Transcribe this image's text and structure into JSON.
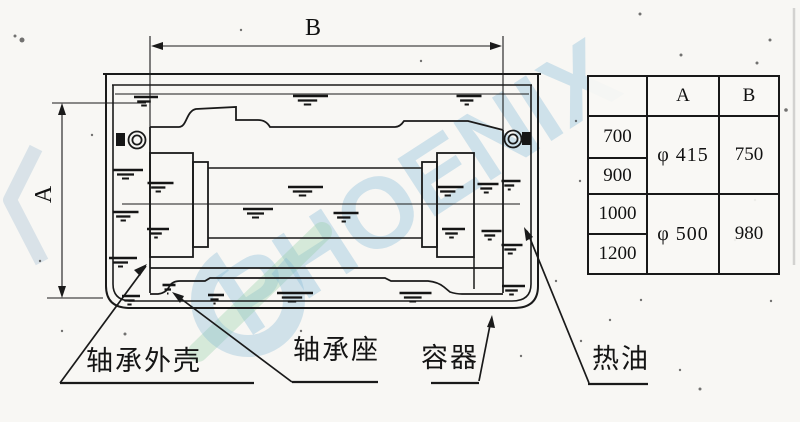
{
  "page": {
    "background": "#f8f7f4",
    "ink": "#1a1a1a"
  },
  "watermark": {
    "text": "PHOENIX",
    "color": "#7eb6d5"
  },
  "dimension_labels": {
    "height": "A",
    "width": "B"
  },
  "callouts": [
    {
      "label": "轴承外壳"
    },
    {
      "label": "轴承座"
    },
    {
      "label": "容器"
    },
    {
      "label": "热油"
    }
  ],
  "spec_table": {
    "headers": [
      "A",
      "B"
    ],
    "groups": [
      {
        "sizes": [
          "700",
          "900"
        ],
        "a": "φ 415",
        "b": "750"
      },
      {
        "sizes": [
          "1000",
          "1200"
        ],
        "a": "φ 500",
        "b": "980"
      }
    ]
  }
}
